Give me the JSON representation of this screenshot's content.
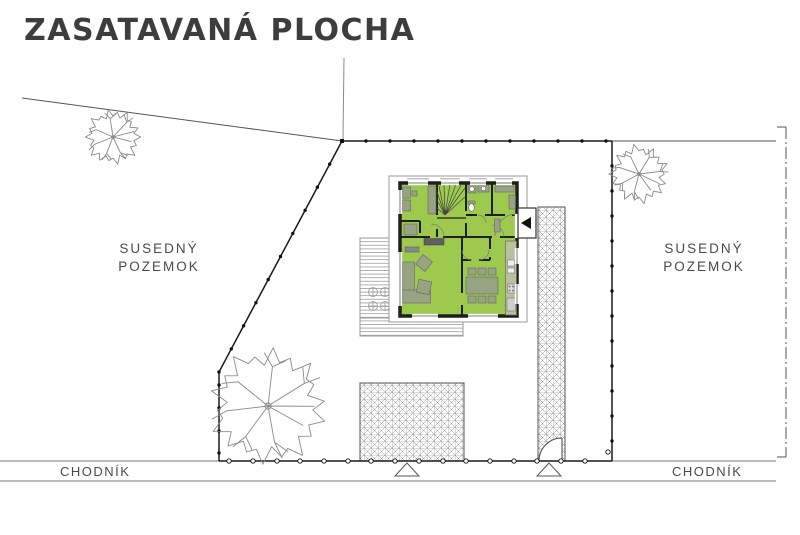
{
  "title": "ZASATAVANÁ PLOCHA",
  "labels": {
    "left_parcel": {
      "line1": "SUSEDNÝ",
      "line2": "POZEMOK"
    },
    "right_parcel": {
      "line1": "SUSEDNÝ",
      "line2": "POZEMOK"
    },
    "sidewalk_left": "CHODNÍK",
    "sidewalk_right": "CHODNÍK"
  },
  "colors": {
    "house_fill": "#9cc94e",
    "house_wall": "#1f1f1f",
    "furniture": "#97a383",
    "kitchen_counter": "#b9c09c",
    "drawing_line": "#4a4a4a",
    "title_color": "#3d3d3d",
    "label_color": "#4a4a4a"
  },
  "symbols": {
    "entrance_arrow_icon": "filled left-pointing triangle at house entrance",
    "gate_marker_icon": "open triangle below sidewalk fence line (2x)",
    "fence_post_icon": "dot markers along plot fence",
    "tree_icon": "sketched deciduous tree outline (3x)"
  }
}
